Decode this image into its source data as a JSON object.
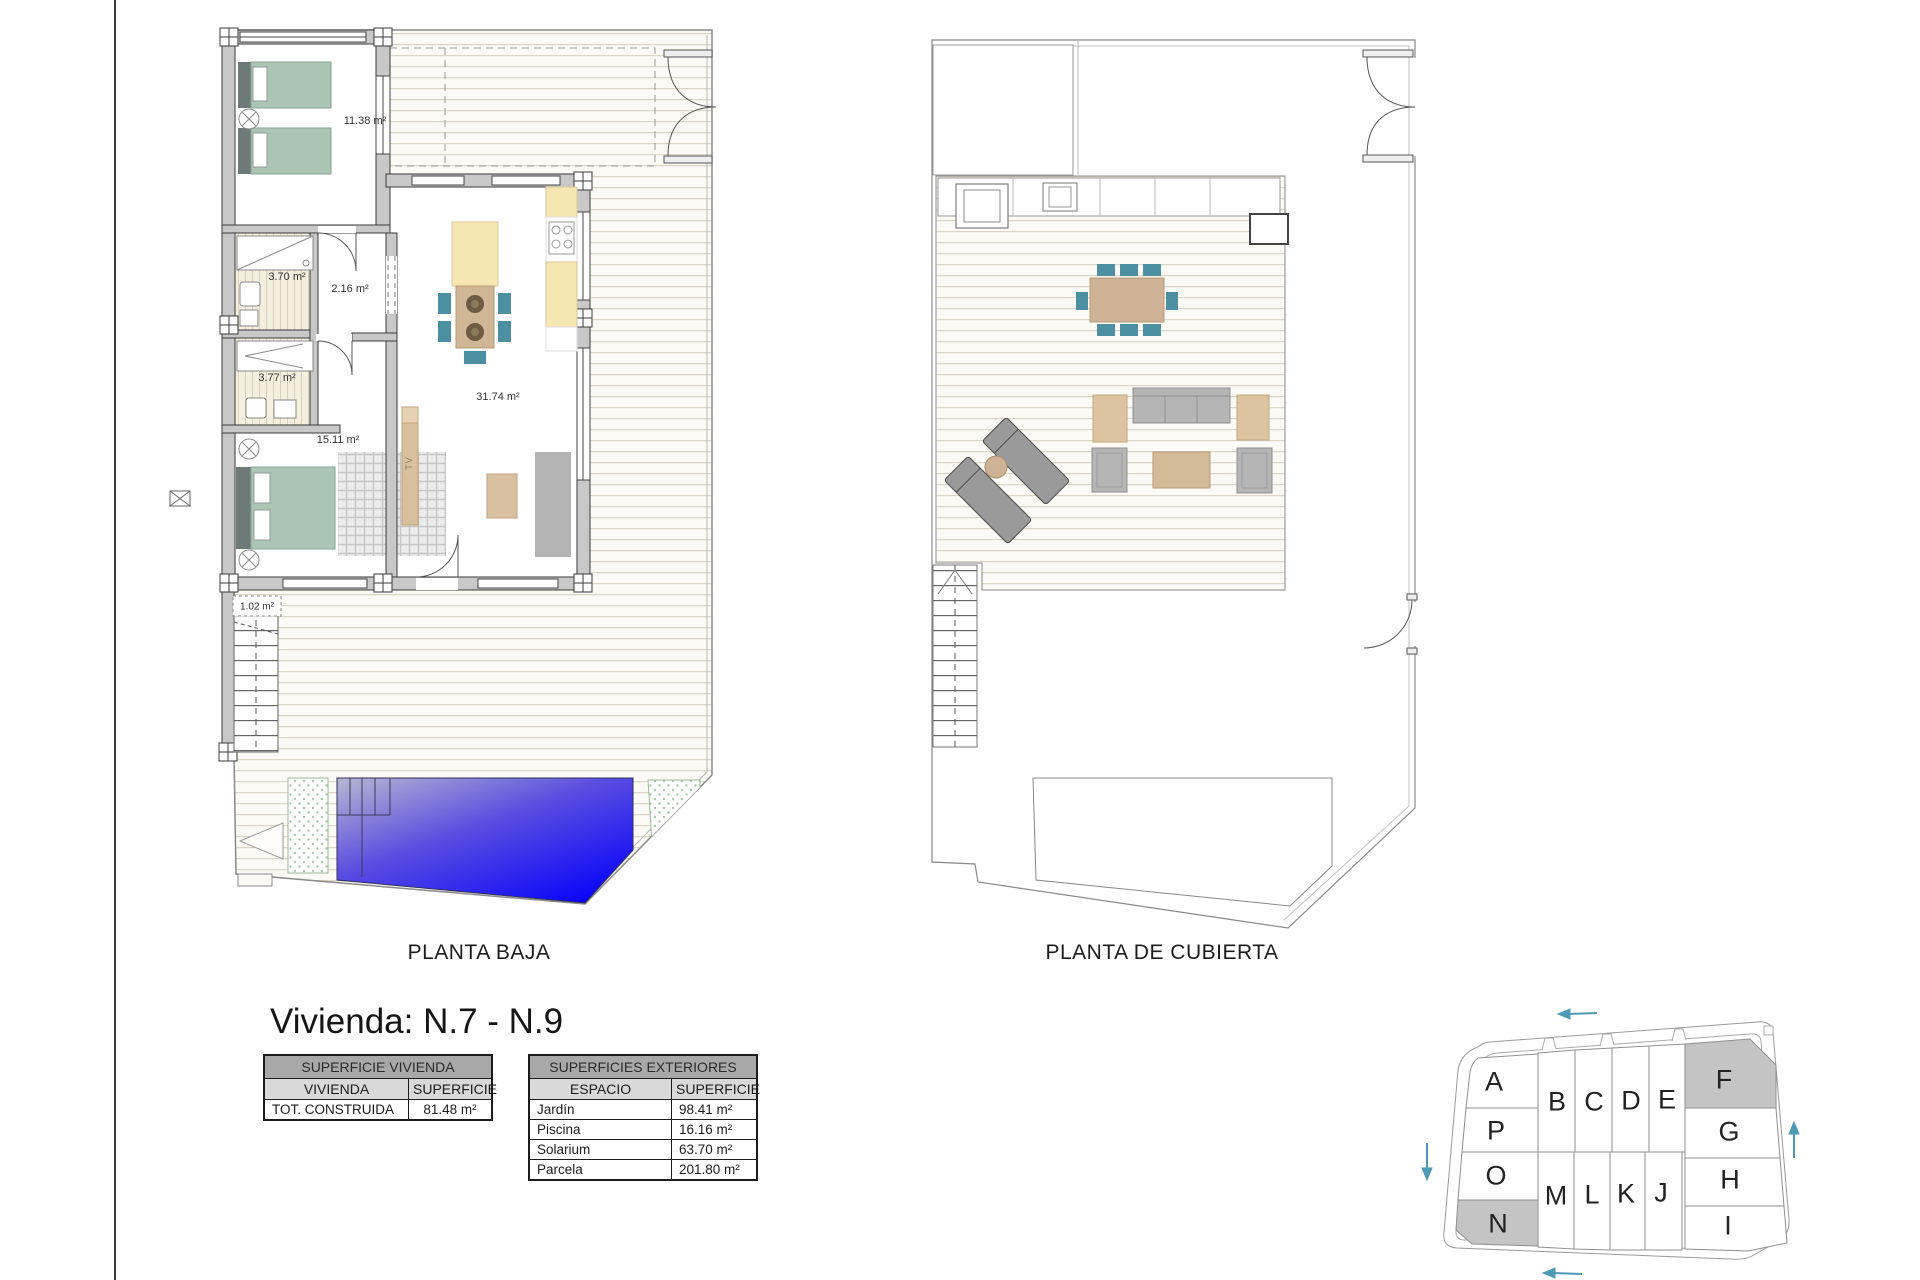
{
  "unit_title": "Vivienda: N.7 - N.9",
  "plans": {
    "baja": {
      "label": "PLANTA BAJA",
      "areas": {
        "bedroom1": "11.38 m²",
        "bath1": "3.70 m²",
        "hall": "2.16 m²",
        "bath2": "3.77 m²",
        "bedroom2": "15.11 m²",
        "living": "31.74 m²",
        "stairs": "1.02 m²"
      },
      "tv_label": "TV"
    },
    "cubierta": {
      "label": "PLANTA DE CUBIERTA"
    }
  },
  "tables": {
    "vivienda": {
      "title": "SUPERFICIE VIVIENDA",
      "columns": [
        "VIVIENDA",
        "SUPERFICIE"
      ],
      "rows": [
        [
          "TOT. CONSTRUIDA",
          "81.48 m²"
        ]
      ]
    },
    "exteriores": {
      "title": "SUPERFICIES EXTERIORES",
      "columns": [
        "ESPACIO",
        "SUPERFICIE"
      ],
      "rows": [
        [
          "Jardín",
          "98.41 m²"
        ],
        [
          "Piscina",
          "16.16 m²"
        ],
        [
          "Solarium",
          "63.70 m²"
        ],
        [
          "Parcela",
          "201.80 m²"
        ]
      ]
    }
  },
  "site_plan": {
    "plots": [
      "A",
      "P",
      "O",
      "N",
      "B",
      "C",
      "D",
      "E",
      "F",
      "G",
      "H",
      "I",
      "M",
      "L",
      "K",
      "J"
    ],
    "highlighted": [
      "F",
      "N"
    ],
    "arrow_color": "#4e9ab5",
    "highlight_gray": "#c4c4c4"
  },
  "colors": {
    "pool_blue": "#0803fa",
    "bed_green": "#abc5b4",
    "chair_teal": "#4b8fa0",
    "wood_tan": "#cdb295",
    "counter_yellow": "#f6e6b2",
    "wall_gray": "#c8c8c8"
  }
}
